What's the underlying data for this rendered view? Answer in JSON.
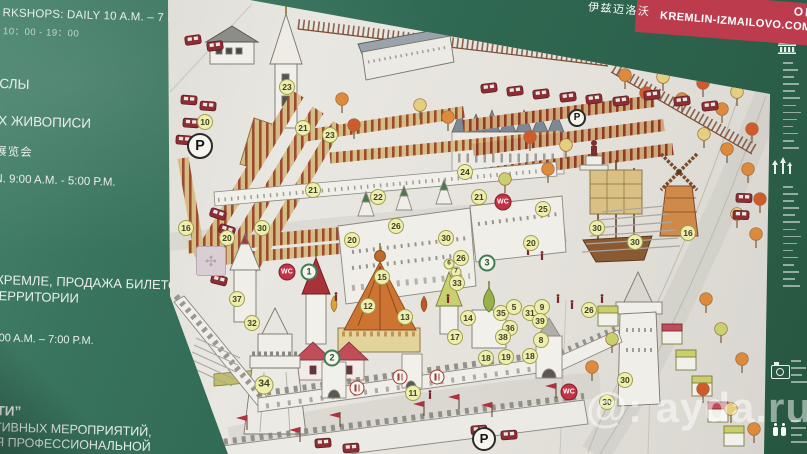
{
  "board": {
    "left_panel": {
      "lp1": "RKSHOPS: DAILY 10 A.M. – 7 P.M.",
      "lp2": "10：00 - 19：00",
      "lp3": "СЛЫ",
      "lp4": "Х ЖИВОПИСИ",
      "lp5": "展览会",
      "lp6": "N. 9:00 A.M. - 5:00 P.M.",
      "lp7": "КРЕМЛЕ, ПРОДАЖА БИЛЕТОВ",
      "lp8": "ТЕРРИТОРИИ",
      "lp9": "С",
      "lp10": "0:00 A.M. – 7:00 P.M.",
      "lp11": "СТИ”",
      "lp12": "АТИВНЫХ МЕРОПРИЯТИЙ,",
      "lp13": "ИЯ ПРОФЕССИОНАЛЬНОЙ"
    },
    "banner": {
      "partial_top": "ОВО",
      "url": "KREMLIN-IZMAILOVO.COM",
      "cjk": "伊兹迈洛沃"
    },
    "watermark": {
      "prefix": "@:",
      "text": "ayda.ru"
    },
    "colors": {
      "board_green": "#2f6852",
      "banner_red": "#bc3b4c",
      "paper": "#e6e4de",
      "marker_yellow": "#edeeb0",
      "wc_red": "#c23347",
      "stall_tan": "#d6bd84",
      "stall_stripe": "#9c4a32"
    }
  },
  "map": {
    "star_tile_icon": "✣",
    "markers": [
      {
        "t": "num",
        "l": "10",
        "x": 205,
        "y": 122
      },
      {
        "t": "p",
        "l": "P",
        "x": 200,
        "y": 146,
        "s": 26
      },
      {
        "t": "num",
        "l": "23",
        "x": 287,
        "y": 87
      },
      {
        "t": "num",
        "l": "21",
        "x": 303,
        "y": 128
      },
      {
        "t": "num",
        "l": "23",
        "x": 330,
        "y": 135
      },
      {
        "t": "num",
        "l": "21",
        "x": 313,
        "y": 190
      },
      {
        "t": "num",
        "l": "22",
        "x": 378,
        "y": 197
      },
      {
        "t": "num",
        "l": "16",
        "x": 186,
        "y": 228
      },
      {
        "t": "num",
        "l": "20",
        "x": 227,
        "y": 238
      },
      {
        "t": "num",
        "l": "30",
        "x": 262,
        "y": 228
      },
      {
        "t": "num",
        "l": "20",
        "x": 352,
        "y": 240
      },
      {
        "t": "num",
        "l": "26",
        "x": 396,
        "y": 226
      },
      {
        "t": "num",
        "l": "24",
        "x": 465,
        "y": 172
      },
      {
        "t": "num",
        "l": "21",
        "x": 479,
        "y": 197
      },
      {
        "t": "wc",
        "l": "WC",
        "x": 503,
        "y": 202
      },
      {
        "t": "num",
        "l": "25",
        "x": 543,
        "y": 209
      },
      {
        "t": "num",
        "l": "30",
        "x": 446,
        "y": 238
      },
      {
        "t": "num",
        "l": "20",
        "x": 531,
        "y": 243
      },
      {
        "t": "num",
        "l": "30",
        "x": 597,
        "y": 228
      },
      {
        "t": "num",
        "l": "30",
        "x": 635,
        "y": 242
      },
      {
        "t": "num",
        "l": "16",
        "x": 688,
        "y": 233
      },
      {
        "t": "wc",
        "l": "WC",
        "x": 287,
        "y": 272
      },
      {
        "t": "green",
        "l": "1",
        "x": 309,
        "y": 272
      },
      {
        "t": "num",
        "l": "15",
        "x": 382,
        "y": 277
      },
      {
        "t": "num",
        "l": "26",
        "x": 461,
        "y": 258
      },
      {
        "t": "green",
        "l": "3",
        "x": 487,
        "y": 263
      },
      {
        "t": "numsm",
        "l": "6",
        "x": 449,
        "y": 264
      },
      {
        "t": "numsm",
        "l": "7",
        "x": 456,
        "y": 272
      },
      {
        "t": "num",
        "l": "33",
        "x": 457,
        "y": 283
      },
      {
        "t": "num",
        "l": "37",
        "x": 237,
        "y": 299
      },
      {
        "t": "num",
        "l": "32",
        "x": 252,
        "y": 323
      },
      {
        "t": "num",
        "l": "34",
        "x": 264,
        "y": 385,
        "s": 19
      },
      {
        "t": "green",
        "l": "2",
        "x": 332,
        "y": 358
      },
      {
        "t": "num",
        "l": "12",
        "x": 368,
        "y": 306
      },
      {
        "t": "num",
        "l": "13",
        "x": 405,
        "y": 317
      },
      {
        "t": "num",
        "l": "11",
        "x": 413,
        "y": 393
      },
      {
        "t": "num",
        "l": "14",
        "x": 468,
        "y": 318
      },
      {
        "t": "num",
        "l": "17",
        "x": 455,
        "y": 337
      },
      {
        "t": "num",
        "l": "35",
        "x": 501,
        "y": 313
      },
      {
        "t": "num",
        "l": "5",
        "x": 514,
        "y": 307
      },
      {
        "t": "num",
        "l": "31",
        "x": 530,
        "y": 313
      },
      {
        "t": "num",
        "l": "9",
        "x": 542,
        "y": 307
      },
      {
        "t": "num",
        "l": "39",
        "x": 540,
        "y": 321
      },
      {
        "t": "num",
        "l": "36",
        "x": 510,
        "y": 328
      },
      {
        "t": "num",
        "l": "38",
        "x": 503,
        "y": 337
      },
      {
        "t": "num",
        "l": "8",
        "x": 541,
        "y": 340
      },
      {
        "t": "num",
        "l": "18",
        "x": 486,
        "y": 358
      },
      {
        "t": "num",
        "l": "19",
        "x": 506,
        "y": 357
      },
      {
        "t": "num",
        "l": "18",
        "x": 530,
        "y": 356
      },
      {
        "t": "num",
        "l": "26",
        "x": 589,
        "y": 310
      },
      {
        "t": "food",
        "l": "",
        "x": 357,
        "y": 388
      },
      {
        "t": "food",
        "l": "",
        "x": 400,
        "y": 377
      },
      {
        "t": "food",
        "l": "",
        "x": 437,
        "y": 377
      },
      {
        "t": "wc",
        "l": "WC",
        "x": 569,
        "y": 392
      },
      {
        "t": "p",
        "l": "P",
        "x": 577,
        "y": 118,
        "s": 18
      },
      {
        "t": "p",
        "l": "P",
        "x": 484,
        "y": 439,
        "s": 24
      },
      {
        "t": "num",
        "l": "30",
        "x": 625,
        "y": 380
      },
      {
        "t": "num",
        "l": "30",
        "x": 607,
        "y": 402
      }
    ]
  }
}
